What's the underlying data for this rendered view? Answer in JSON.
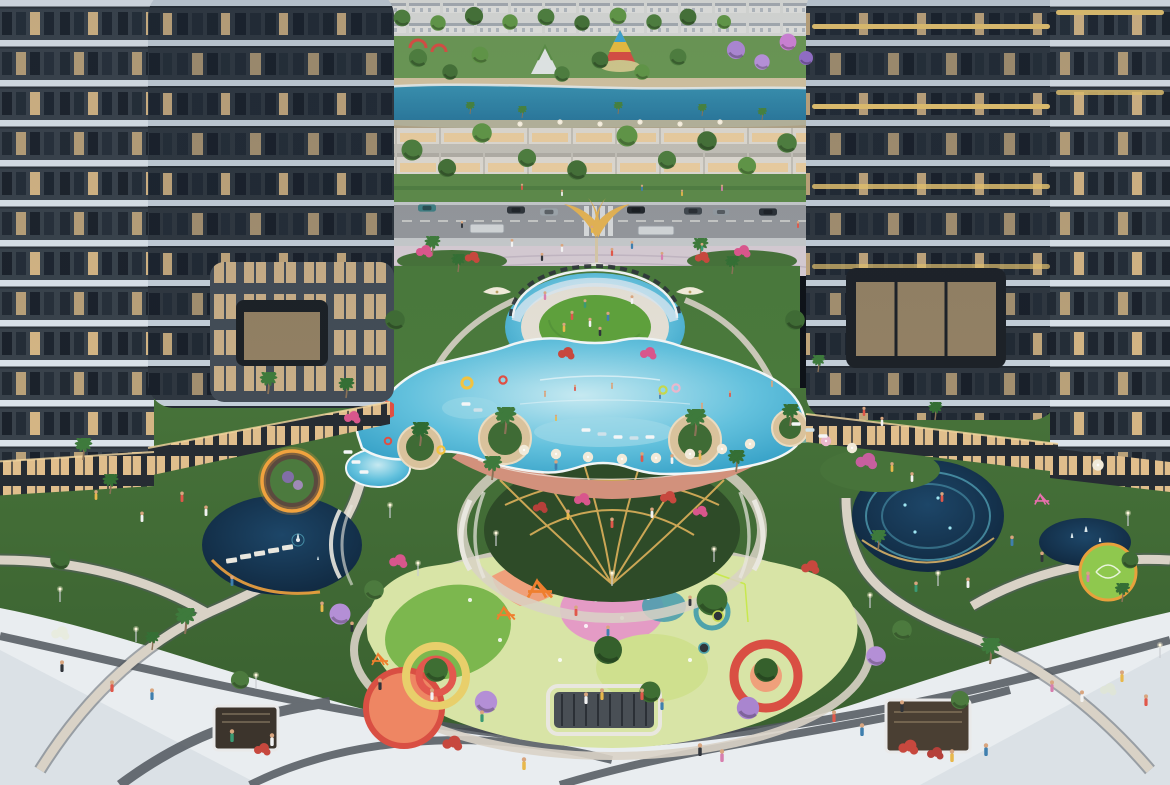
{
  "palette": {
    "facade_dark": "#39424b",
    "facade_inner": "#2f3740",
    "band_white": "#dbe3ea",
    "band_soft": "#c3ced8",
    "gold_band": "#e6c36f",
    "window_dark": "#1b222b",
    "window_warm": "#f0c98e",
    "retail_glow": "#f4cf96",
    "park_green": "#6e9c55",
    "garden_green": "#47733a",
    "garden_dark": "#3a6130",
    "lawn": "#5fa23c",
    "lake": "#3a95b4",
    "lake_deep": "#27759b",
    "sand": "#d9c8a4",
    "road": "#96999d",
    "sidewalk": "#c8cbcd",
    "plaza_paving": "#d8cdd5",
    "plaza_white": "#e9edf0",
    "stripe_dark": "#51575e",
    "path_beige": "#d9d2c6",
    "pool_light": "#c6e9f1",
    "pool_mid": "#63c1dd",
    "pool_deep": "#2e9bc3",
    "pool_edge": "#f2f6f6",
    "deck_salmon": "#d2917c",
    "planter_sand": "#d9c29c",
    "pond_light": "#1d4668",
    "pond_dark": "#0e2338",
    "glow_orange": "#f0a23e",
    "glow_cyan": "#6fd8e8",
    "pergola_gold": "#ddb05a",
    "glass": "#d9e9f2",
    "play_base": "#d8e4a6",
    "play_green": "#7cb74e",
    "play_pink": "#e49bc5",
    "play_salmon": "#efa07b",
    "play_teal": "#4e9fae",
    "play_yellow": "#e8cf6b",
    "play_red": "#d94f43",
    "play_orange": "#ee8663",
    "statue_gold": "#e7b554",
    "carousel_red": "#e04f43",
    "carousel_yellow": "#f2c340",
    "carousel_blue": "#3fa9d8",
    "town_white": "#e9e9e5",
    "shop_cream": "#e3ded4",
    "hedge": "#5f8c4a"
  },
  "stamps": [
    [
      "ca",
      427,
      208,
      "#3f7d82",
      1
    ],
    [
      "ca",
      516,
      210,
      "#2f353b",
      1
    ],
    [
      "ca",
      549,
      212,
      "#9aa2a8",
      1
    ],
    [
      "ca",
      636,
      210,
      "#23282d",
      1
    ],
    [
      "ca",
      693,
      211,
      "#41484f",
      1
    ],
    [
      "ca",
      721,
      212,
      "#8f979e",
      0.9
    ],
    [
      "ca",
      768,
      212,
      "#2b3138",
      1
    ],
    [
      "pa",
      432,
      256,
      "#3e7a3c",
      1
    ],
    [
      "pa",
      458,
      272,
      "#356f35",
      0.9
    ],
    [
      "pa",
      700,
      258,
      "#3e7a3c",
      1
    ],
    [
      "pa",
      732,
      274,
      "#356f35",
      0.9
    ],
    [
      "pa",
      268,
      394,
      "#3e7a3c",
      1.1
    ],
    [
      "pa",
      346,
      398,
      "#356f35",
      1
    ],
    [
      "pa",
      818,
      372,
      "#3e7a3c",
      0.85
    ],
    [
      "pa",
      420,
      446,
      "#2f6b33",
      1.2
    ],
    [
      "pa",
      505,
      434,
      "#3e7a3c",
      1.35
    ],
    [
      "pa",
      695,
      436,
      "#3e7a3c",
      1.35
    ],
    [
      "pa",
      790,
      426,
      "#356f35",
      1.1
    ],
    [
      "pa",
      492,
      480,
      "#3e7a3c",
      1.2
    ],
    [
      "pa",
      736,
      472,
      "#356f35",
      1.1
    ],
    [
      "pa",
      83,
      460,
      "#3e7a3c",
      1.1
    ],
    [
      "pa",
      110,
      494,
      "#356f35",
      1
    ],
    [
      "pa",
      185,
      634,
      "#3e7a3c",
      1.3
    ],
    [
      "pa",
      152,
      650,
      "#356f35",
      0.9
    ],
    [
      "pa",
      990,
      664,
      "#3e7a3c",
      1.3
    ],
    [
      "pa",
      935,
      420,
      "#356f35",
      0.9
    ],
    [
      "pa",
      878,
      550,
      "#3e7a3c",
      1
    ],
    [
      "pa",
      1122,
      602,
      "#356f35",
      0.95
    ],
    [
      "pa",
      470,
      114,
      "#468040",
      0.6
    ],
    [
      "pa",
      522,
      118,
      "#468040",
      0.6
    ],
    [
      "pa",
      618,
      114,
      "#468040",
      0.6
    ],
    [
      "pa",
      702,
      116,
      "#468040",
      0.6
    ],
    [
      "pa",
      762,
      120,
      "#468040",
      0.6
    ],
    [
      "tr",
      402,
      18,
      "#4d7c3f",
      1.2
    ],
    [
      "tr",
      438,
      23,
      "#5f9347",
      1.1
    ],
    [
      "tr",
      474,
      16,
      "#446f38",
      1.3
    ],
    [
      "tr",
      510,
      22,
      "#5f9347",
      1.1
    ],
    [
      "tr",
      546,
      17,
      "#4d7c3f",
      1.2
    ],
    [
      "tr",
      582,
      23,
      "#446f38",
      1.1
    ],
    [
      "tr",
      618,
      16,
      "#5f9347",
      1.2
    ],
    [
      "tr",
      654,
      22,
      "#4d7c3f",
      1.1
    ],
    [
      "tr",
      688,
      17,
      "#446f38",
      1.2
    ],
    [
      "tr",
      724,
      22,
      "#5f9347",
      1
    ],
    [
      "tr",
      736,
      50,
      "#a985cf",
      1.3
    ],
    [
      "tr",
      762,
      62,
      "#b48fd6",
      1.1
    ],
    [
      "tr",
      788,
      42,
      "#c77fd0",
      1.2
    ],
    [
      "tr",
      806,
      58,
      "#8f6cc2",
      1
    ],
    [
      "tr",
      418,
      58,
      "#4d7c3f",
      1.3
    ],
    [
      "tr",
      450,
      72,
      "#446f38",
      1.1
    ],
    [
      "tr",
      480,
      55,
      "#5f9347",
      1.2
    ],
    [
      "tr",
      562,
      74,
      "#4d7c3f",
      1.1
    ],
    [
      "tr",
      600,
      60,
      "#446f38",
      1.2
    ],
    [
      "tr",
      642,
      72,
      "#5f9347",
      1.1
    ],
    [
      "tr",
      678,
      57,
      "#4d7c3f",
      1.2
    ],
    [
      "tr",
      412,
      150,
      "#4d7c3f",
      1.5
    ],
    [
      "tr",
      447,
      168,
      "#446f38",
      1.3
    ],
    [
      "tr",
      482,
      133,
      "#5f9347",
      1.4
    ],
    [
      "tr",
      527,
      158,
      "#4d7c3f",
      1.3
    ],
    [
      "tr",
      577,
      170,
      "#446f38",
      1.4
    ],
    [
      "tr",
      627,
      136,
      "#5f9347",
      1.5
    ],
    [
      "tr",
      667,
      160,
      "#4d7c3f",
      1.3
    ],
    [
      "tr",
      707,
      141,
      "#446f38",
      1.4
    ],
    [
      "tr",
      747,
      166,
      "#5f9347",
      1.3
    ],
    [
      "tr",
      787,
      143,
      "#4d7c3f",
      1.4
    ],
    [
      "tr",
      712,
      600,
      "#3e6e33",
      2.2
    ],
    [
      "tr",
      608,
      650,
      "#35602c",
      2
    ],
    [
      "tr",
      436,
      670,
      "#3e6e33",
      1.7
    ],
    [
      "tr",
      766,
      670,
      "#35602c",
      1.7
    ],
    [
      "tr",
      650,
      692,
      "#3e6e33",
      1.5
    ],
    [
      "tr",
      486,
      702,
      "#b48fd6",
      1.6
    ],
    [
      "tr",
      748,
      708,
      "#a985cf",
      1.6
    ],
    [
      "tr",
      340,
      614,
      "#b48fd6",
      1.5
    ],
    [
      "tr",
      876,
      656,
      "#b48fd6",
      1.4
    ],
    [
      "tr",
      374,
      590,
      "#4c7a3e",
      1.4
    ],
    [
      "tr",
      902,
      630,
      "#4c7a3e",
      1.4
    ],
    [
      "tr",
      395,
      320,
      "#3f6b35",
      1.4
    ],
    [
      "tr",
      795,
      320,
      "#3f6b35",
      1.4
    ],
    [
      "tr",
      960,
      700,
      "#4c7a3e",
      1.3
    ],
    [
      "tr",
      240,
      680,
      "#4c7a3e",
      1.3
    ],
    [
      "tr",
      60,
      560,
      "#3f6b35",
      1.4
    ],
    [
      "tr",
      1130,
      560,
      "#3f6b35",
      1.2
    ],
    [
      "sh",
      452,
      744,
      "#c7483e",
      1.2
    ],
    [
      "sh",
      908,
      748,
      "#c7483e",
      1.2
    ],
    [
      "sh",
      262,
      750,
      "#c7483e",
      1
    ],
    [
      "sh",
      935,
      754,
      "#b5403a",
      1
    ],
    [
      "sh",
      566,
      354,
      "#c7483e",
      1
    ],
    [
      "sh",
      648,
      354,
      "#d8568c",
      1
    ],
    [
      "sh",
      424,
      252,
      "#d8568c",
      1
    ],
    [
      "sh",
      472,
      258,
      "#c7483e",
      0.9
    ],
    [
      "sh",
      742,
      252,
      "#d8568c",
      1
    ],
    [
      "sh",
      702,
      258,
      "#c7483e",
      0.9
    ],
    [
      "sh",
      398,
      562,
      "#d8568c",
      1.1
    ],
    [
      "sh",
      810,
      568,
      "#c7483e",
      1.1
    ],
    [
      "sh",
      866,
      462,
      "#c75f9e",
      1.3
    ],
    [
      "sh",
      352,
      418,
      "#d8568c",
      1
    ],
    [
      "sh",
      60,
      634,
      "#e8ecdf",
      1.1
    ],
    [
      "sh",
      1108,
      690,
      "#dfe5d8",
      1
    ],
    [
      "sh",
      582,
      500,
      "#d8568c",
      1
    ],
    [
      "sh",
      668,
      498,
      "#c7483e",
      1
    ],
    [
      "sh",
      540,
      508,
      "#b5403a",
      0.9
    ],
    [
      "sh",
      700,
      512,
      "#d8568c",
      0.9
    ],
    [
      "um",
      524,
      450,
      "#f1ead9",
      1
    ],
    [
      "um",
      556,
      454,
      "#f1ead9",
      1
    ],
    [
      "um",
      588,
      457,
      "#f1ead9",
      1
    ],
    [
      "um",
      622,
      459,
      "#f1ead9",
      1
    ],
    [
      "um",
      656,
      458,
      "#f1ead9",
      1
    ],
    [
      "um",
      690,
      454,
      "#f1ead9",
      1
    ],
    [
      "um",
      722,
      449,
      "#f1ead9",
      1
    ],
    [
      "um",
      750,
      444,
      "#f1ead9",
      1
    ],
    [
      "um",
      826,
      441,
      "#eab7cc",
      1
    ],
    [
      "um",
      852,
      448,
      "#f1ead9",
      1
    ],
    [
      "um",
      1098,
      465,
      "#f1ead9",
      1.1
    ],
    [
      "um",
      520,
      124,
      "#f1ead9",
      0.5
    ],
    [
      "um",
      560,
      122,
      "#f1ead9",
      0.5
    ],
    [
      "um",
      600,
      124,
      "#f1ead9",
      0.5
    ],
    [
      "um",
      640,
      122,
      "#f1ead9",
      0.5
    ],
    [
      "um",
      680,
      124,
      "#f1ead9",
      0.5
    ],
    [
      "um",
      720,
      122,
      "#f1ead9",
      0.5
    ],
    [
      "cp",
      497,
      292,
      "#efe9d8",
      1.4
    ],
    [
      "cp",
      690,
      292,
      "#efe9d8",
      1.4
    ],
    [
      "lo",
      348,
      452,
      "#f4f6f7",
      1
    ],
    [
      "lo",
      356,
      462,
      "#f4f6f7",
      1
    ],
    [
      "lo",
      364,
      472,
      "#f4f6f7",
      1
    ],
    [
      "lo",
      796,
      424,
      "#f4f6f7",
      1
    ],
    [
      "lo",
      810,
      430,
      "#cfe2ea",
      1
    ],
    [
      "lo",
      823,
      436,
      "#f4f6f7",
      1
    ],
    [
      "lo",
      586,
      430,
      "#f4f6f7",
      1
    ],
    [
      "lo",
      602,
      434,
      "#cfe2ea",
      1
    ],
    [
      "lo",
      618,
      437,
      "#f4f6f7",
      1
    ],
    [
      "lo",
      634,
      438,
      "#cfe2ea",
      1
    ],
    [
      "lo",
      650,
      437,
      "#f4f6f7",
      1
    ],
    [
      "lo",
      466,
      404,
      "#f4f6f7",
      1
    ],
    [
      "lo",
      478,
      410,
      "#cfe2ea",
      1
    ],
    [
      "fl",
      467,
      383,
      "#f2c340",
      1.4
    ],
    [
      "fl",
      503,
      380,
      "#e04f43",
      1
    ],
    [
      "fl",
      663,
      390,
      "#c4d84e",
      1
    ],
    [
      "fl",
      676,
      388,
      "#eab7cc",
      1
    ],
    [
      "fl",
      441,
      450,
      "#f2c340",
      1
    ],
    [
      "fl",
      388,
      441,
      "#e04f43",
      0.9
    ],
    [
      "pe",
      545,
      397,
      "#d8a57f",
      0.55
    ],
    [
      "pe",
      575,
      391,
      "#e0574a",
      0.55
    ],
    [
      "pe",
      612,
      389,
      "#d8a57f",
      0.55
    ],
    [
      "pe",
      660,
      399,
      "#3f7fae",
      0.55
    ],
    [
      "pe",
      702,
      409,
      "#d8a57f",
      0.55
    ],
    [
      "pe",
      730,
      397,
      "#e0574a",
      0.55
    ],
    [
      "pe",
      772,
      387,
      "#d8a57f",
      0.55
    ],
    [
      "pe",
      556,
      421,
      "#e8b84b",
      0.55
    ],
    [
      "pe",
      586,
      704,
      "#f2f2f2",
      1
    ],
    [
      "pe",
      602,
      700,
      "#e8b84b",
      1
    ],
    [
      "pe",
      642,
      700,
      "#e0574a",
      1
    ],
    [
      "pe",
      662,
      710,
      "#3f7fae",
      1
    ],
    [
      "pe",
      700,
      756,
      "#30343a",
      1.1
    ],
    [
      "pe",
      722,
      762,
      "#d77fae",
      1.1
    ],
    [
      "pe",
      524,
      770,
      "#e8b84b",
      1.1
    ],
    [
      "pe",
      482,
      722,
      "#3a9a74",
      1
    ],
    [
      "pe",
      432,
      700,
      "#f2f2f2",
      1
    ],
    [
      "pe",
      834,
      722,
      "#e0574a",
      1
    ],
    [
      "pe",
      862,
      736,
      "#3f7fae",
      1.1
    ],
    [
      "pe",
      902,
      712,
      "#30343a",
      1
    ],
    [
      "pe",
      1052,
      692,
      "#d77fae",
      1
    ],
    [
      "pe",
      1082,
      702,
      "#f2f2f2",
      1
    ],
    [
      "pe",
      1122,
      682,
      "#e8b84b",
      1
    ],
    [
      "pe",
      152,
      700,
      "#3f7fae",
      1
    ],
    [
      "pe",
      112,
      692,
      "#e0574a",
      1
    ],
    [
      "pe",
      62,
      672,
      "#30343a",
      1
    ],
    [
      "pe",
      232,
      742,
      "#3a9a74",
      1.1
    ],
    [
      "pe",
      272,
      746,
      "#f2f2f2",
      1.1
    ],
    [
      "pe",
      952,
      762,
      "#e8b84b",
      1.1
    ],
    [
      "pe",
      986,
      756,
      "#3f7fae",
      1.1
    ],
    [
      "pe",
      1146,
      706,
      "#e0574a",
      1
    ],
    [
      "pe",
      380,
      690,
      "#30343a",
      1
    ],
    [
      "pe",
      182,
      502,
      "#e0574a",
      0.9
    ],
    [
      "pe",
      206,
      516,
      "#f2f2f2",
      0.9
    ],
    [
      "pe",
      232,
      586,
      "#3f7fae",
      0.9
    ],
    [
      "pe",
      322,
      612,
      "#e8b84b",
      0.9
    ],
    [
      "pe",
      352,
      632,
      "#30343a",
      0.9
    ],
    [
      "pe",
      892,
      472,
      "#e8b84b",
      0.85
    ],
    [
      "pe",
      912,
      482,
      "#f2f2f2",
      0.85
    ],
    [
      "pe",
      942,
      502,
      "#e0574a",
      0.85
    ],
    [
      "pe",
      1012,
      546,
      "#3f7fae",
      0.9
    ],
    [
      "pe",
      1042,
      562,
      "#30343a",
      0.9
    ],
    [
      "pe",
      1088,
      582,
      "#d77fae",
      0.9
    ],
    [
      "pe",
      864,
      416,
      "#e0574a",
      0.8
    ],
    [
      "pe",
      882,
      426,
      "#f2f2f2",
      0.8
    ],
    [
      "pe",
      562,
      252,
      "#f2f2f2",
      0.7
    ],
    [
      "pe",
      612,
      256,
      "#e0574a",
      0.7
    ],
    [
      "pe",
      632,
      249,
      "#3f7fae",
      0.7
    ],
    [
      "pe",
      592,
      233,
      "#e8b84b",
      0.65
    ],
    [
      "pe",
      542,
      261,
      "#30343a",
      0.7
    ],
    [
      "pe",
      662,
      260,
      "#d77fae",
      0.7
    ],
    [
      "pe",
      702,
      251,
      "#3a9a74",
      0.7
    ],
    [
      "pe",
      512,
      247,
      "#f2f2f2",
      0.7
    ],
    [
      "pe",
      462,
      228,
      "#30343a",
      0.6
    ],
    [
      "pe",
      798,
      228,
      "#e0574a",
      0.6
    ],
    [
      "pe",
      522,
      190,
      "#e0574a",
      0.55
    ],
    [
      "pe",
      562,
      196,
      "#f2f2f2",
      0.55
    ],
    [
      "pe",
      642,
      191,
      "#3f7fae",
      0.55
    ],
    [
      "pe",
      682,
      196,
      "#e8b84b",
      0.55
    ],
    [
      "pe",
      722,
      191,
      "#d77fae",
      0.55
    ],
    [
      "pe",
      572,
      320,
      "#e0574a",
      0.8
    ],
    [
      "pe",
      590,
      327,
      "#f2f2f2",
      0.8
    ],
    [
      "pe",
      608,
      321,
      "#3f7fae",
      0.8
    ],
    [
      "pe",
      564,
      332,
      "#e8b84b",
      0.8
    ],
    [
      "pe",
      600,
      336,
      "#30343a",
      0.8
    ],
    [
      "pe",
      585,
      308,
      "#3a9a74",
      0.75
    ],
    [
      "pe",
      545,
      300,
      "#d77fae",
      0.75
    ],
    [
      "pe",
      632,
      304,
      "#f2f2f2",
      0.75
    ],
    [
      "pe",
      642,
      462,
      "#e0574a",
      0.85
    ],
    [
      "pe",
      672,
      464,
      "#f2f2f2",
      0.85
    ],
    [
      "pe",
      700,
      460,
      "#e8b84b",
      0.85
    ],
    [
      "pe",
      556,
      470,
      "#3f7fae",
      0.85
    ],
    [
      "pe",
      568,
      520,
      "#e8b84b",
      0.9
    ],
    [
      "pe",
      612,
      528,
      "#e0574a",
      0.9
    ],
    [
      "pe",
      652,
      518,
      "#f2f2f2",
      0.9
    ],
    [
      "pe",
      690,
      606,
      "#30343a",
      0.9
    ],
    [
      "pe",
      916,
      592,
      "#3a9a74",
      0.9
    ],
    [
      "pe",
      968,
      588,
      "#f2f2f2",
      0.9
    ],
    [
      "pe",
      576,
      616,
      "#e0574a",
      0.9
    ],
    [
      "pe",
      608,
      636,
      "#3f7fae",
      0.9
    ],
    [
      "pe",
      142,
      522,
      "#f2f2f2",
      0.9
    ],
    [
      "pe",
      96,
      500,
      "#e8b84b",
      0.85
    ],
    [
      "la",
      60,
      602,
      "#fff7dc",
      1
    ],
    [
      "la",
      136,
      642,
      "#fff7dc",
      1
    ],
    [
      "la",
      256,
      688,
      "#fff7dc",
      1
    ],
    [
      "la",
      390,
      518,
      "#fff7dc",
      1
    ],
    [
      "la",
      496,
      546,
      "#fff7dc",
      1
    ],
    [
      "la",
      612,
      586,
      "#fff7dc",
      1
    ],
    [
      "la",
      714,
      562,
      "#fff7dc",
      1
    ],
    [
      "la",
      938,
      586,
      "#fff7dc",
      1
    ],
    [
      "la",
      1128,
      526,
      "#fff7dc",
      1
    ],
    [
      "la",
      1160,
      658,
      "#fff7dc",
      1
    ],
    [
      "la",
      870,
      608,
      "#fff7dc",
      1
    ],
    [
      "la",
      418,
      576,
      "#fff7dc",
      1
    ],
    [
      "fr",
      540,
      590,
      "#ef7f2e",
      1.5
    ],
    [
      "fr",
      506,
      614,
      "#ef7f2e",
      1.1
    ],
    [
      "fr",
      380,
      660,
      "#ef7f2e",
      1
    ],
    [
      "fr",
      1042,
      500,
      "#e86fae",
      0.9
    ],
    [
      "tm",
      718,
      616,
      "#c4d84e",
      1
    ],
    [
      "tm",
      704,
      648,
      "#4ea3ab",
      1
    ],
    [
      "je",
      298,
      538,
      "#e8f4f6",
      1
    ],
    [
      "je",
      318,
      560,
      "#e8f4f6",
      0.8
    ],
    [
      "je",
      1072,
      538,
      "#eef8fa",
      1.1
    ],
    [
      "je",
      1086,
      532,
      "#eef8fa",
      1.3
    ],
    [
      "je",
      1100,
      542,
      "#eef8fa",
      1
    ]
  ]
}
